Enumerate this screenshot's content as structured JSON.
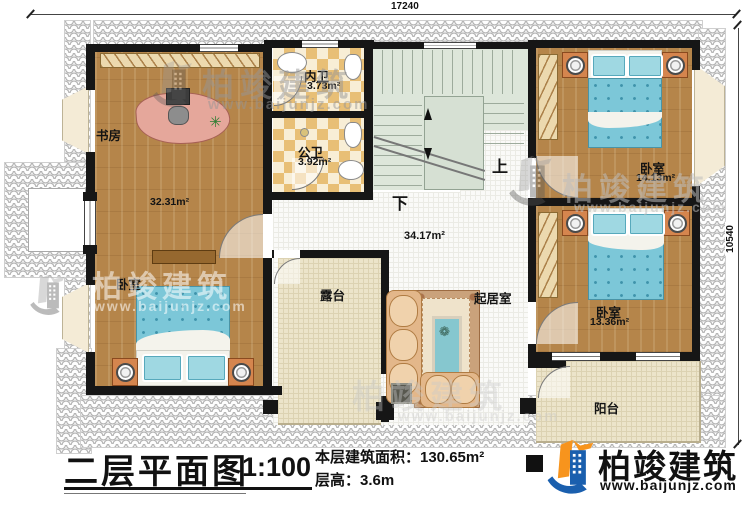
{
  "dimensions": {
    "top": "17240",
    "right": "10540"
  },
  "rooms": {
    "study": {
      "label": "书房"
    },
    "suite": {
      "area": "32.31m²",
      "bedroom_label": "卧室"
    },
    "inner_bath": {
      "label": "内卫",
      "area": "3.73m²"
    },
    "public_bath": {
      "label": "公卫",
      "area": "3.92m²"
    },
    "hall": {
      "area": "34.17m²"
    },
    "bedroom_top_right": {
      "label": "卧室",
      "area": "14.13m²"
    },
    "bedroom_mid_right": {
      "label": "卧室",
      "area": "13.36m²"
    },
    "terrace": {
      "label": "露台"
    },
    "living": {
      "label": "起居室"
    },
    "balcony": {
      "label": "阳台"
    }
  },
  "stairs": {
    "up_label": "上",
    "down_label": "下"
  },
  "title_block": {
    "title": "二层平面图",
    "scale": "1:100",
    "area_text": "本层建筑面积：130.65m²",
    "height_text": "层高：3.6m"
  },
  "brand": {
    "name": "柏竣建筑",
    "website": "www.baijunjz.com"
  },
  "watermark": {
    "name": "柏竣建筑",
    "website": "www.baijunjz.com"
  },
  "colors": {
    "brand_blue": "#1a5fae",
    "brand_orange": "#f7941d",
    "wall_black": "#161616",
    "wood_floor": "#b5854a",
    "bathroom_tile": "#e8bf76",
    "stair_green": "#dde6da",
    "terrace_cream": "#ece4ca",
    "bed_teal": "#7cc7d8"
  }
}
